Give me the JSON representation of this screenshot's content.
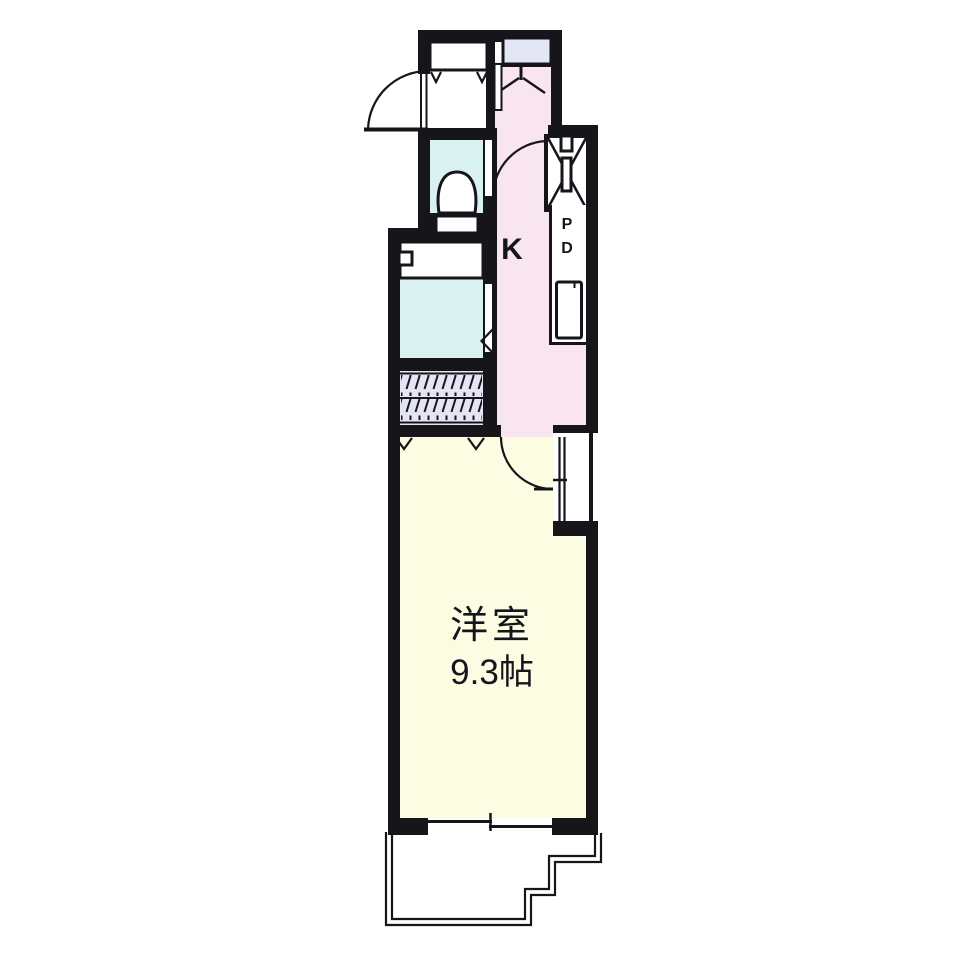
{
  "floor_plan": {
    "labels": {
      "kitchen": "K",
      "main_room_name": "洋室",
      "main_room_size": "9.3帖",
      "pipe_duct_letters": [
        "P",
        "D"
      ]
    },
    "colors": {
      "wall": "#15151a",
      "kitchen_hall": "#f8e5ef",
      "main_room": "#fcfce3",
      "bathroom_toilet": "#d9f2f1",
      "closet": "#e4e4f3",
      "upper_closet": "#e3e6f5",
      "canvas": "#ffffff",
      "label_text": "#15151d"
    }
  }
}
